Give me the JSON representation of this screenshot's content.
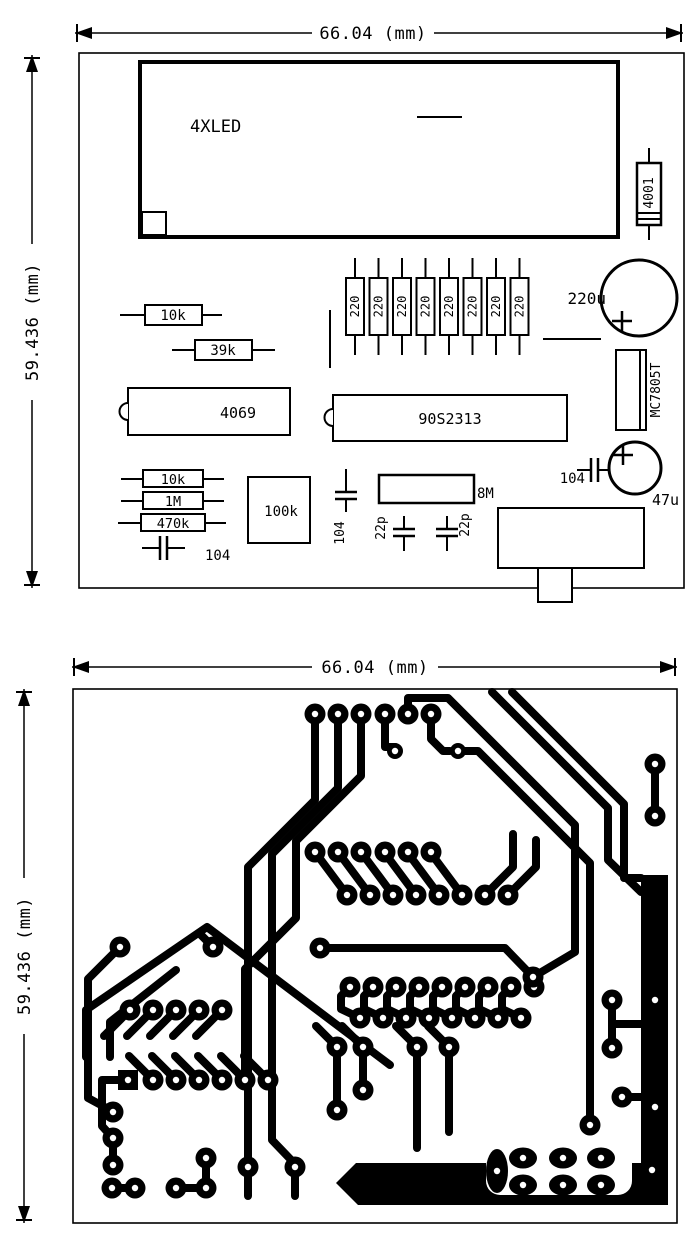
{
  "doc": {
    "type": "pcb-drawing",
    "view_count": 2
  },
  "dimensions": {
    "width_label": "66.04 (mm)",
    "height_label": "59.436 (mm)"
  },
  "colors": {
    "ink": "#000000",
    "paper": "#ffffff"
  },
  "top_view": {
    "description": "component-placement-silkscreen",
    "components": {
      "led_display": "4XLED",
      "diode": "4001",
      "cap_electrolytic_large": "220u",
      "resistor_array_value": "220",
      "resistor_array_count": 8,
      "r_10k_upper": "10k",
      "r_39k": "39k",
      "ic_inverter": "4069",
      "ic_mcu": "90S2313",
      "regulator": "MC7805T",
      "r_10k_lower": "10k",
      "r_1m": "1M",
      "r_470k": "470k",
      "cap_104_left": "104",
      "trimmer": "100k",
      "cap_104_mid": "104",
      "cap_22p_1": "22p",
      "cap_22p_2": "22p",
      "crystal": "8M",
      "cap_104_right": "104",
      "cap_47u": "47u"
    }
  },
  "bottom_view": {
    "description": "copper-trace-layout"
  }
}
